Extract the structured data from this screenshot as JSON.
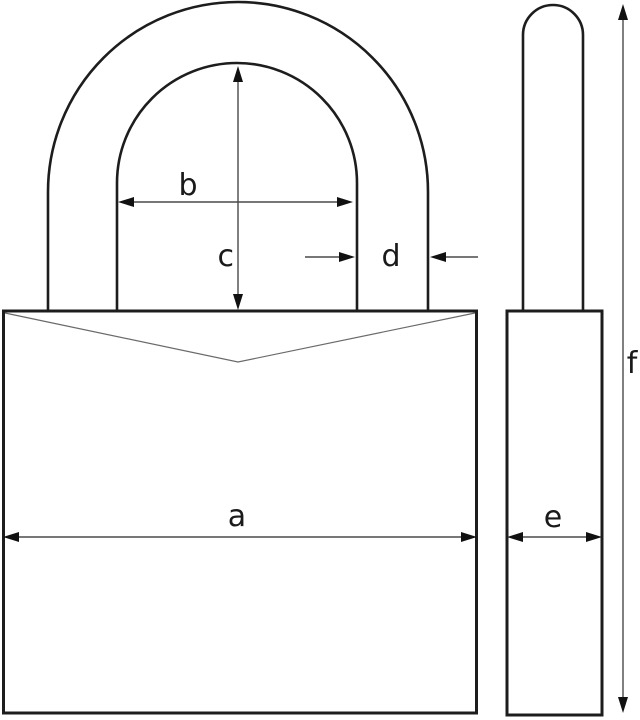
{
  "diagram": {
    "kind": "padlock dimension drawing",
    "views": [
      "front",
      "side"
    ]
  },
  "dimensions": {
    "a": "a",
    "b": "b",
    "c": "c",
    "d": "d",
    "e": "e",
    "f": "f"
  },
  "colors": {
    "background": "#ffffff",
    "outline": "#1d1d1d",
    "dimension_line": "#4a4a4a",
    "label_text": "#1a1a1a"
  }
}
